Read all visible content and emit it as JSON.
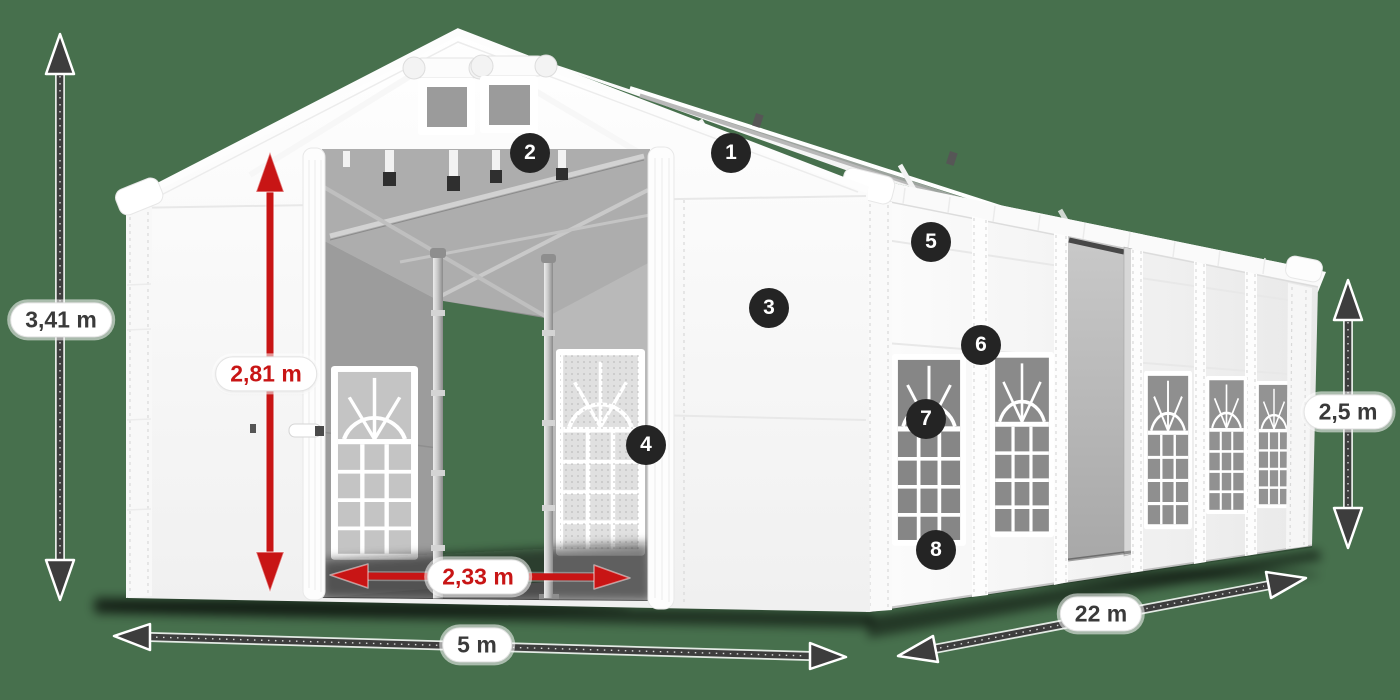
{
  "scene": {
    "description": "White marquee party tent shown in perspective with dimension arrows and numbered feature callouts",
    "background_color": "#47704d",
    "tent_color": "#ffffff",
    "red_accent": "#c81515",
    "arrow_color": "#3d3d3d",
    "badge_color": "#242424"
  },
  "dimensions": {
    "total_height": "3,41 m",
    "entrance_height": "2,81 m",
    "entrance_width": "2,33 m",
    "front_width": "5 m",
    "side_length": "22 m",
    "wall_height": "2,5 m"
  },
  "callouts": [
    "1",
    "2",
    "3",
    "4",
    "5",
    "6",
    "7",
    "8"
  ]
}
